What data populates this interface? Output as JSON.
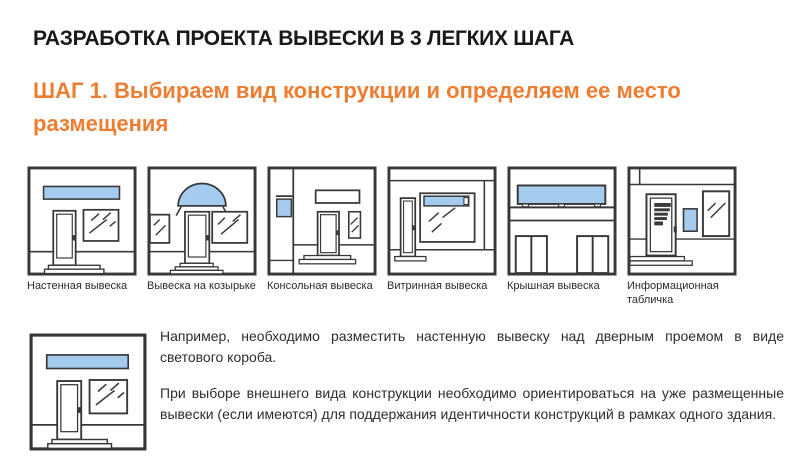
{
  "page": {
    "title": "РАЗРАБОТКА ПРОЕКТА ВЫВЕСКИ В 3 ЛЕГКИХ ШАГА",
    "step_heading": "ШАГ 1. Выбираем вид конструкции и определяем ее место размещения"
  },
  "colors": {
    "accent_orange": "#ED7D31",
    "sign_blue": "#A5CBEE",
    "outline_dark": "#383838"
  },
  "sign_types": [
    {
      "label": "Настенная вывеска",
      "icon": "storefront-wall-sign-icon"
    },
    {
      "label": "Вывеска на козырьке",
      "icon": "storefront-canopy-sign-icon"
    },
    {
      "label": "Консольная вывеска",
      "icon": "storefront-console-sign-icon"
    },
    {
      "label": "Витринная вывеска",
      "icon": "storefront-window-sign-icon"
    },
    {
      "label": "Крышная вывеска",
      "icon": "storefront-roof-sign-icon"
    },
    {
      "label": "Информационная табличка",
      "icon": "storefront-info-plaque-icon"
    }
  ],
  "example": {
    "icon": "storefront-wall-sign-icon",
    "paragraphs": {
      "p1": "Например, необходимо разместить настенную вывеску над дверным проемом в виде светового короба.",
      "p2": "При выборе внешнего вида конструкции необходимо ориентироваться на уже размещенные вывески (если имеются) для поддержания идентичности конструкций в рамках одного здания."
    }
  }
}
